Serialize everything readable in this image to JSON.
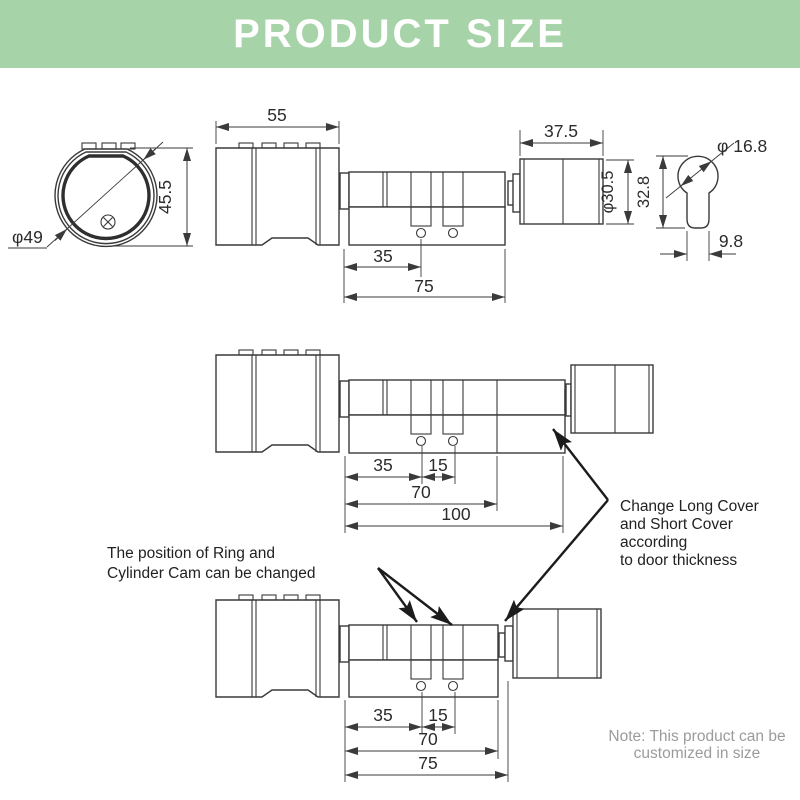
{
  "header": {
    "title": "PRODUCT SIZE",
    "bg_color": "#a7d3a9",
    "text_color": "#ffffff"
  },
  "colors": {
    "line": "#3a3a3a",
    "dim_text": "#2b2b2b",
    "note_text": "#9b9b9b"
  },
  "front_view": {
    "diameter_label": "φ49",
    "height_label": "45.5"
  },
  "top_view": {
    "knob_width_label": "55",
    "dim_35": "35",
    "dim_75": "75",
    "cover_width_label": "37.5",
    "cover_diameter_label": "φ30.5"
  },
  "keyhole_view": {
    "diameter_label": "φ 16.8",
    "height_label": "32.8",
    "stem_width_label": "9.8"
  },
  "middle_view": {
    "dim_35": "35",
    "dim_15": "15",
    "dim_70": "70",
    "dim_100": "100"
  },
  "bottom_view": {
    "dim_35": "35",
    "dim_15": "15",
    "dim_70": "70",
    "dim_75": "75"
  },
  "annotations": {
    "ring_cam": {
      "line1": "The position of Ring and",
      "line2": "Cylinder Cam can be changed"
    },
    "cover": {
      "line1": "Change Long Cover",
      "line2": "and Short Cover",
      "line3": "according",
      "line4": "to door thickness"
    },
    "note": {
      "line1": "Note: This product can be",
      "line2": "customized in size"
    }
  }
}
